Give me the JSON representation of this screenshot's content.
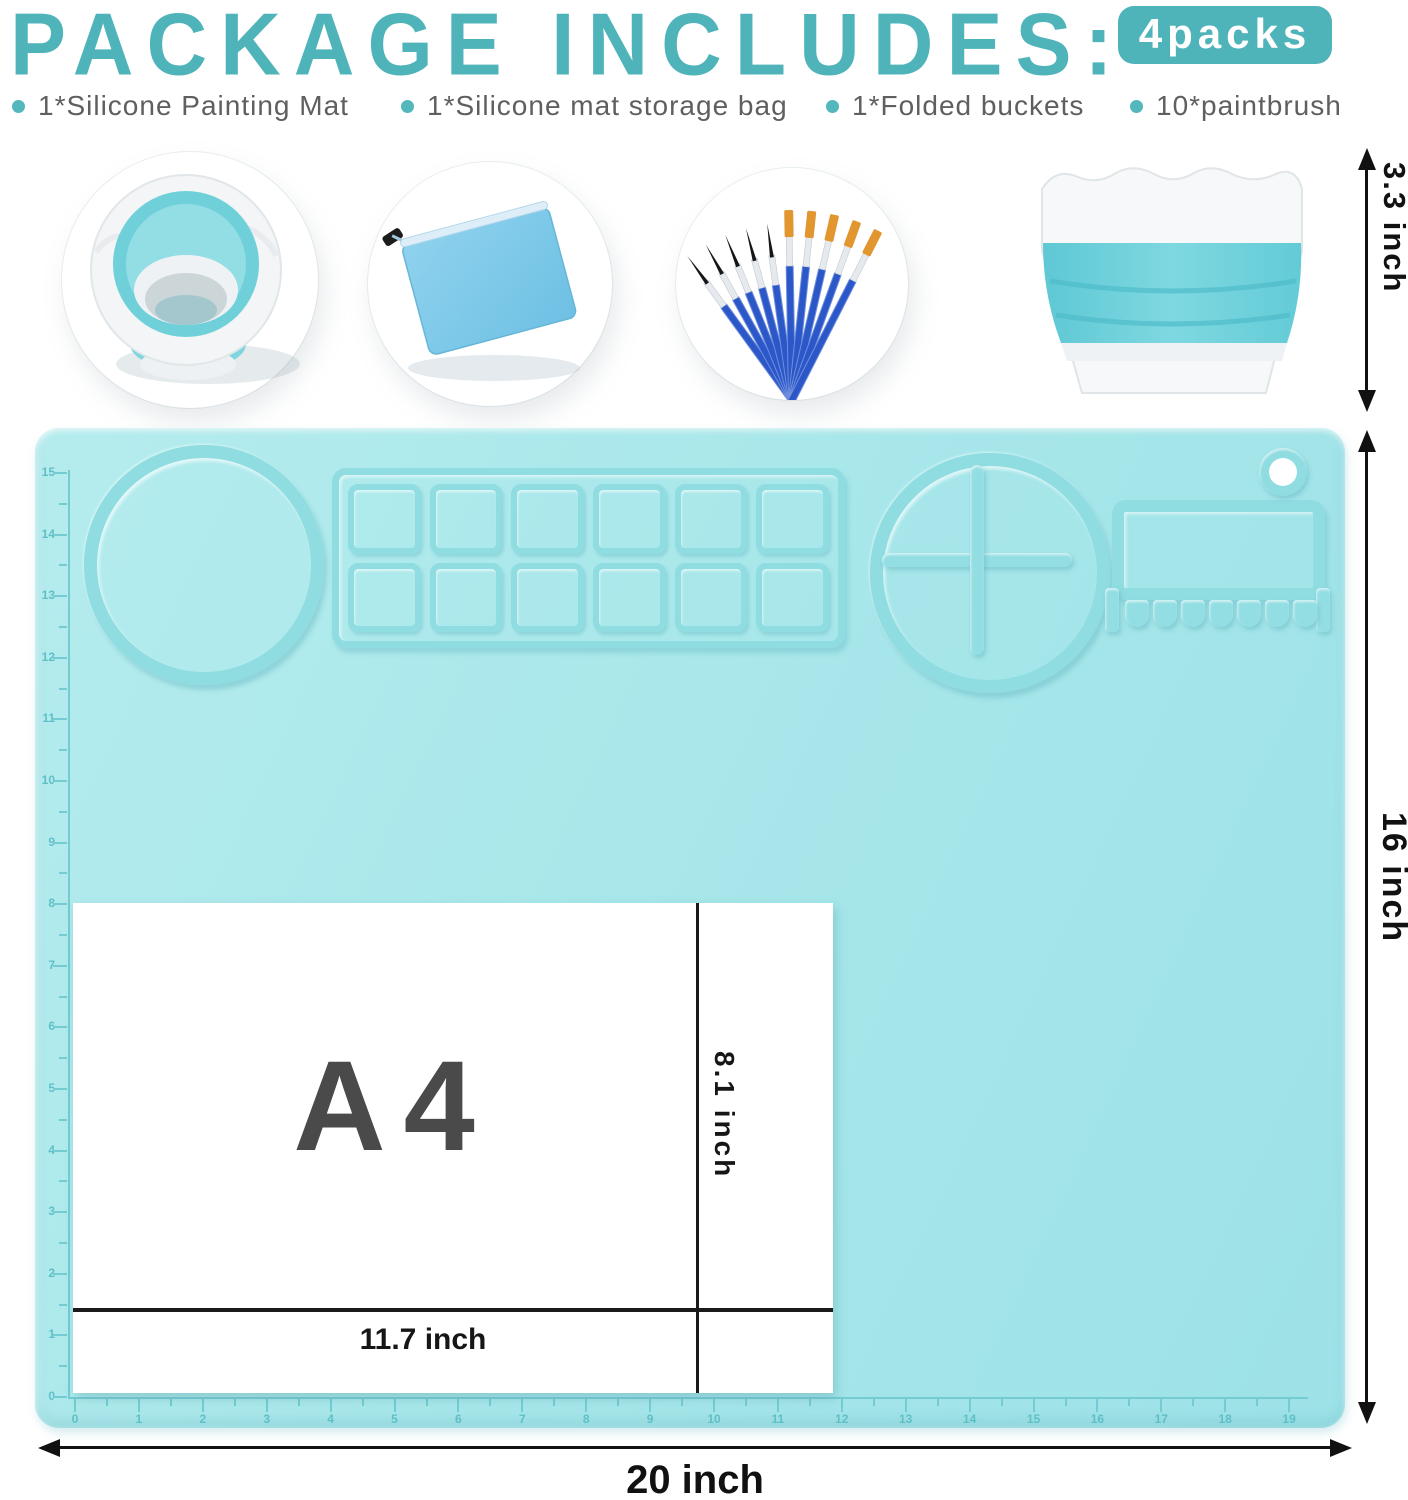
{
  "header": {
    "title": "PACKAGE INCLUDES:",
    "badge": "4packs"
  },
  "includes": [
    {
      "label": "1*Silicone Painting Mat"
    },
    {
      "label": "1*Silicone mat storage bag"
    },
    {
      "label": "1*Folded buckets"
    },
    {
      "label": "10*paintbrush"
    }
  ],
  "photos": [
    {
      "name": "collapsible-bucket-top-view"
    },
    {
      "name": "silicone-mat-storage-bag"
    },
    {
      "name": "paintbrush-set"
    },
    {
      "name": "folded-bucket-side-view"
    }
  ],
  "dimensions": {
    "bucket_height": "3.3 inch",
    "mat_height": "16 inch",
    "mat_width": "20 inch",
    "paper_size": "A4",
    "paper_height": "8.1 inch",
    "paper_width": "11.7 inch"
  },
  "mat": {
    "left_ruler": [
      "15",
      "14",
      "13",
      "12",
      "11",
      "10",
      "9",
      "8",
      "7",
      "6",
      "5",
      "4",
      "3",
      "2",
      "1",
      "0"
    ],
    "bottom_ruler": [
      "0",
      "1",
      "2",
      "3",
      "4",
      "5",
      "6",
      "7",
      "8",
      "9",
      "10",
      "11",
      "12",
      "13",
      "14",
      "15",
      "16",
      "17",
      "18",
      "19"
    ],
    "palette": {
      "rows": 2,
      "cols": 6
    },
    "brush_rest_slots": 7
  },
  "colors": {
    "accent_teal": "#4FB4BA",
    "mat_teal": "#A7E7EA",
    "ridge_teal": "#8FDCE1",
    "bag_blue": "#7FC9E9",
    "brush_blue": "#2B57C8",
    "list_text_gray": "#5F5F5F"
  }
}
